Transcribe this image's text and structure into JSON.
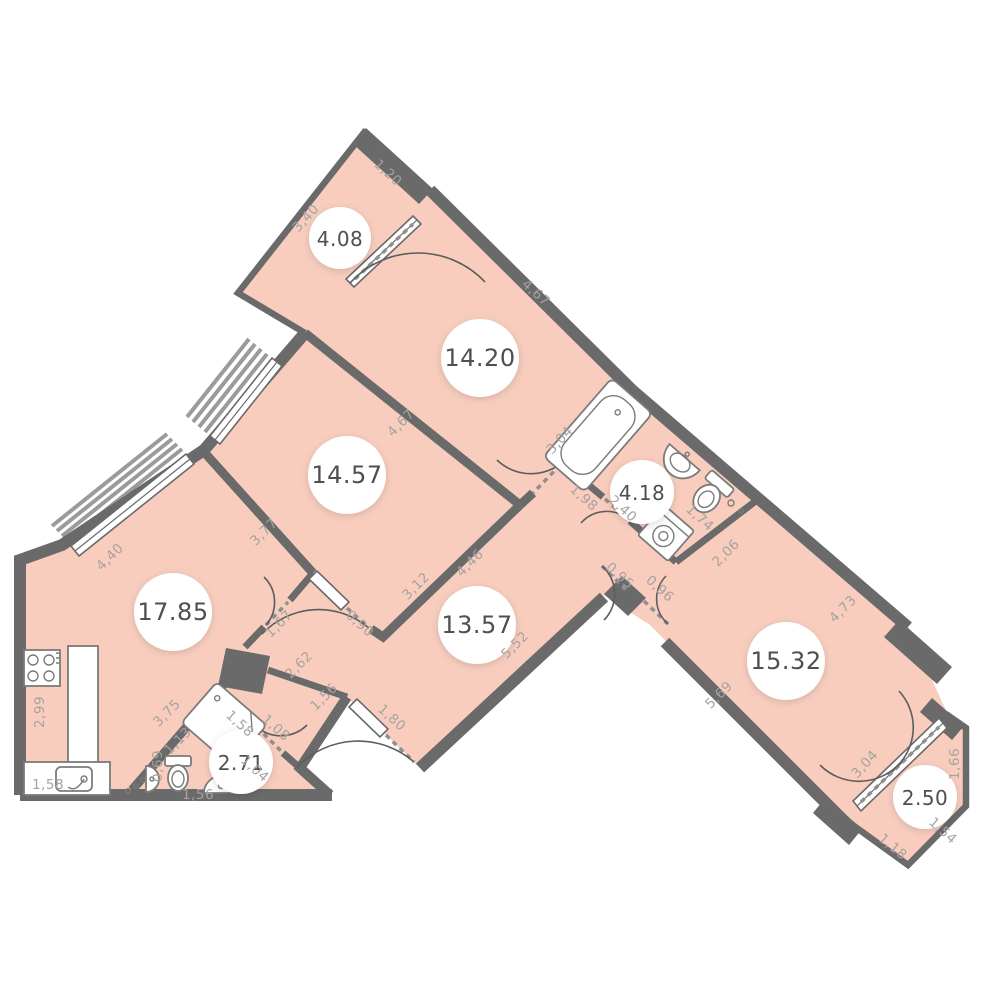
{
  "plan": {
    "type": "apartment-floor-plan",
    "colors": {
      "floor": "#f8cdbe",
      "wall": "#6a6a6a",
      "dim_text": "#a6a2a0",
      "area_text": "#4f4f4f"
    },
    "rooms": [
      {
        "id": "balcony-top",
        "area": "4.08",
        "dims": [
          "3,40",
          "1,20"
        ]
      },
      {
        "id": "room-upper",
        "area": "14.20",
        "dims": [
          "4,67",
          "3,04"
        ]
      },
      {
        "id": "room-middle",
        "area": "14.57",
        "dims": [
          "4,67",
          "3,77",
          "3,12",
          "0,90"
        ]
      },
      {
        "id": "kitchen-living",
        "area": "17.85",
        "dims": [
          "4,40",
          "2,99",
          "1,58",
          "3,75",
          "1,67"
        ]
      },
      {
        "id": "hallway",
        "area": "13.57",
        "dims": [
          "4,46",
          "5,52",
          "2,62",
          "1,56",
          "1,80",
          "0,95",
          "0,96",
          "1,98"
        ]
      },
      {
        "id": "bathroom",
        "area": "4.18",
        "dims": [
          "2,40",
          "1,74"
        ]
      },
      {
        "id": "room-right",
        "area": "15.32",
        "dims": [
          "2,06",
          "4,73",
          "5,69",
          "3,04"
        ]
      },
      {
        "id": "wc",
        "area": "2.71",
        "dims": [
          "1,58",
          "1,13",
          "1,08",
          "1,04",
          "0,69",
          "1,56"
        ]
      },
      {
        "id": "balcony-bottom",
        "area": "2.50",
        "dims": [
          "1,66",
          "1,54",
          "1,18"
        ]
      }
    ]
  }
}
